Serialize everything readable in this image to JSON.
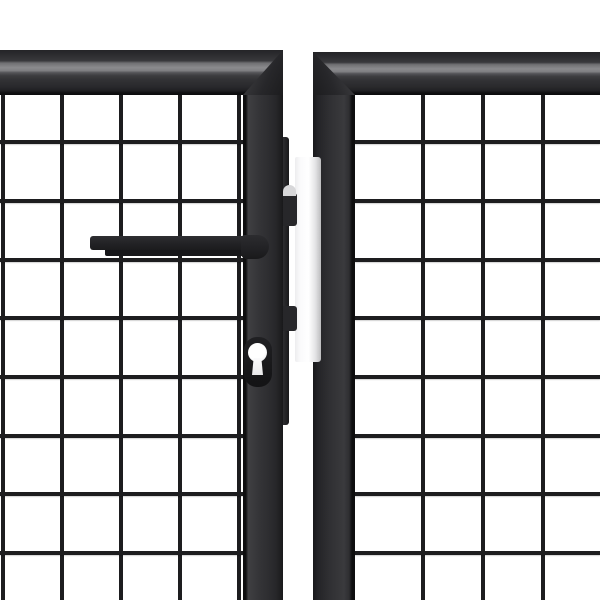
{
  "meta": {
    "description": "Close-up product photo of an anthracite grey double garden gate: two mitred box-profile frames with welded wire mesh infill, a horizontal lever handle and euro-cylinder keyhole on the left leaf, dark latch tabs and a white lock keeper plate in the gap between the leaves, on a plain white background",
    "background": "#ffffff"
  },
  "colors": {
    "frame_dark": "#2c2c2f",
    "frame_highlight": "#8a8a8d",
    "frame_edge": "#0e0e0f",
    "mesh_wire": "#1d1d1f",
    "hardware": "#1f1f22",
    "keeper_plate": "#f5f5f7",
    "keyhole_fill": "#ffffff"
  },
  "mesh": {
    "wire_color": "#1d1d1f",
    "wire_thickness": 4,
    "panels": {
      "left": {
        "origin_x": 0,
        "origin_y": 95,
        "width": 243,
        "height": 505,
        "vertical_x": [
          3,
          62,
          121,
          180,
          239
        ],
        "horizontal_y": [
          142,
          201,
          260,
          318,
          377,
          436,
          494,
          553
        ]
      },
      "right": {
        "origin_x": 355,
        "origin_y": 95,
        "width": 245,
        "height": 505,
        "vertical_x": [
          423,
          483,
          543
        ],
        "horizontal_y": [
          142,
          201,
          260,
          318,
          377,
          436,
          494,
          553
        ]
      }
    }
  }
}
